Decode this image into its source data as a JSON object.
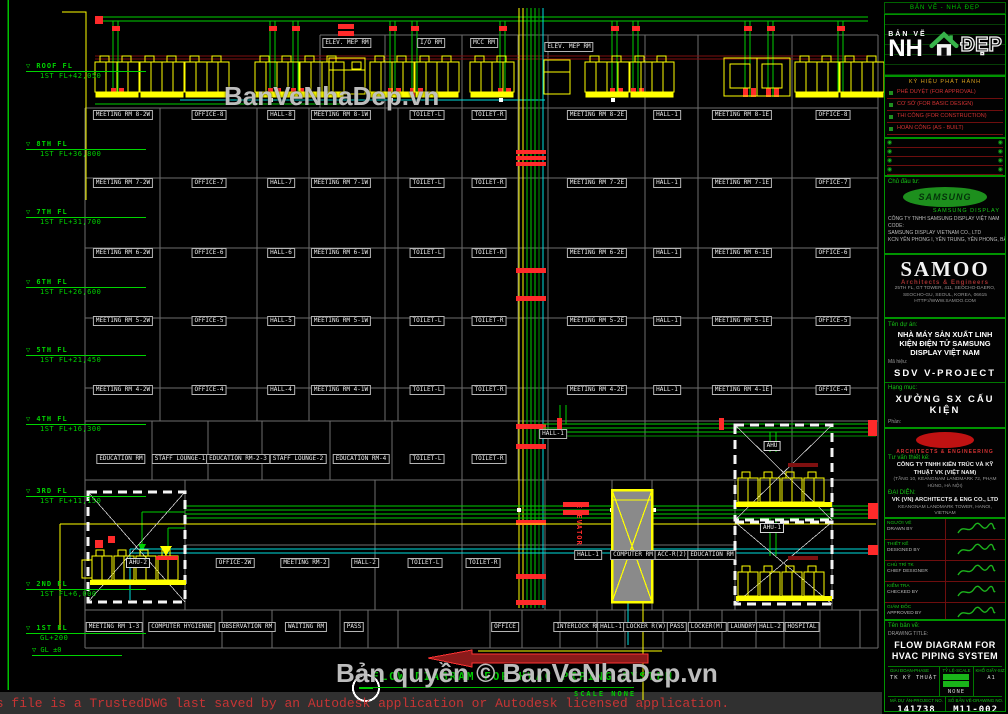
{
  "palette": {
    "bg": "#000000",
    "grid": "#6e6e6e",
    "green_pipe": "#00d000",
    "dark_green": "#008f00",
    "yellow": "#ffff00",
    "cyan": "#00dede",
    "red": "#ff2a2a",
    "dark_red": "#7f1010",
    "level_green": "#00d400",
    "watermark_gray": "#cdcdcd",
    "sidebar_green": "#009400"
  },
  "main": {
    "watermark_mid": "BanVeNhaDep.vn",
    "watermark_bottom": "Bản quyền © BanVeNhaDep.vn",
    "title": "FLOW DIAGRAM FOR HVAC PIPING SYSTEM",
    "scale": "SCALE  NONE",
    "trusted": "is file is a TrustedDWG last saved by an Autodesk application or Autodesk licensed application.",
    "elevator_tag": "ELEVATOR"
  },
  "floors": [
    {
      "n": "ROOF FL",
      "e": "1ST FL+42,050",
      "y": 62
    },
    {
      "n": "8TH FL",
      "e": "1ST FL+36,800",
      "y": 140
    },
    {
      "n": "7TH FL",
      "e": "1ST FL+31,700",
      "y": 208
    },
    {
      "n": "6TH FL",
      "e": "1ST FL+26,600",
      "y": 278
    },
    {
      "n": "5TH FL",
      "e": "1ST FL+21,450",
      "y": 346
    },
    {
      "n": "4TH FL",
      "e": "1ST FL+16,300",
      "y": 415
    },
    {
      "n": "3RD FL",
      "e": "1ST FL+11,150",
      "y": 487
    },
    {
      "n": "2ND FL",
      "e": "1ST FL+6,000",
      "y": 580
    },
    {
      "n": "1ST FL",
      "e": "GL+200",
      "y": 624,
      "extra": "GL ±0"
    }
  ],
  "room_labels": [
    {
      "t": "ELEV. MEP RM",
      "x": 347,
      "y": 42
    },
    {
      "t": "I/O RM",
      "x": 431,
      "y": 42
    },
    {
      "t": "MCC RM",
      "x": 484,
      "y": 42
    },
    {
      "t": "ELEV. MEP RM",
      "x": 569,
      "y": 46
    },
    {
      "t": "MEETING RM 8-2W",
      "x": 123,
      "y": 114
    },
    {
      "t": "OFFICE-8",
      "x": 209,
      "y": 114
    },
    {
      "t": "HALL-8",
      "x": 281,
      "y": 114
    },
    {
      "t": "MEETING RM 8-1W",
      "x": 341,
      "y": 114
    },
    {
      "t": "TOILET-L",
      "x": 427,
      "y": 114
    },
    {
      "t": "TOILET-R",
      "x": 489,
      "y": 114
    },
    {
      "t": "MEETING RM 8-2E",
      "x": 597,
      "y": 114
    },
    {
      "t": "HALL-1",
      "x": 667,
      "y": 114
    },
    {
      "t": "MEETING RM 8-1E",
      "x": 742,
      "y": 114
    },
    {
      "t": "OFFICE-8",
      "x": 833,
      "y": 114
    },
    {
      "t": "MEETING RM 7-2W",
      "x": 123,
      "y": 182
    },
    {
      "t": "OFFICE-7",
      "x": 209,
      "y": 182
    },
    {
      "t": "HALL-7",
      "x": 281,
      "y": 182
    },
    {
      "t": "MEETING RM 7-1W",
      "x": 341,
      "y": 182
    },
    {
      "t": "TOILET-L",
      "x": 427,
      "y": 182
    },
    {
      "t": "TOILET-R",
      "x": 489,
      "y": 182
    },
    {
      "t": "MEETING RM 7-2E",
      "x": 597,
      "y": 182
    },
    {
      "t": "HALL-1",
      "x": 667,
      "y": 182
    },
    {
      "t": "MEETING RM 7-1E",
      "x": 742,
      "y": 182
    },
    {
      "t": "OFFICE-7",
      "x": 833,
      "y": 182
    },
    {
      "t": "MEETING RM 6-2W",
      "x": 123,
      "y": 252
    },
    {
      "t": "OFFICE-6",
      "x": 209,
      "y": 252
    },
    {
      "t": "HALL-6",
      "x": 281,
      "y": 252
    },
    {
      "t": "MEETING RM 6-1W",
      "x": 341,
      "y": 252
    },
    {
      "t": "TOILET-L",
      "x": 427,
      "y": 252
    },
    {
      "t": "TOILET-R",
      "x": 489,
      "y": 252
    },
    {
      "t": "MEETING RM 6-2E",
      "x": 597,
      "y": 252
    },
    {
      "t": "HALL-1",
      "x": 667,
      "y": 252
    },
    {
      "t": "MEETING RM 6-1E",
      "x": 742,
      "y": 252
    },
    {
      "t": "OFFICE-6",
      "x": 833,
      "y": 252
    },
    {
      "t": "MEETING RM 5-2W",
      "x": 123,
      "y": 320
    },
    {
      "t": "OFFICE-5",
      "x": 209,
      "y": 320
    },
    {
      "t": "HALL-5",
      "x": 281,
      "y": 320
    },
    {
      "t": "MEETING RM 5-1W",
      "x": 341,
      "y": 320
    },
    {
      "t": "TOILET-L",
      "x": 427,
      "y": 320
    },
    {
      "t": "TOILET-R",
      "x": 489,
      "y": 320
    },
    {
      "t": "MEETING RM 5-2E",
      "x": 597,
      "y": 320
    },
    {
      "t": "HALL-1",
      "x": 667,
      "y": 320
    },
    {
      "t": "MEETING RM 5-1E",
      "x": 742,
      "y": 320
    },
    {
      "t": "OFFICE-5",
      "x": 833,
      "y": 320
    },
    {
      "t": "MEETING RM 4-2W",
      "x": 123,
      "y": 389
    },
    {
      "t": "OFFICE-4",
      "x": 209,
      "y": 389
    },
    {
      "t": "HALL-4",
      "x": 281,
      "y": 389
    },
    {
      "t": "MEETING RM 4-1W",
      "x": 341,
      "y": 389
    },
    {
      "t": "TOILET-L",
      "x": 427,
      "y": 389
    },
    {
      "t": "TOILET-R",
      "x": 489,
      "y": 389
    },
    {
      "t": "MEETING RM 4-2E",
      "x": 597,
      "y": 389
    },
    {
      "t": "HALL-1",
      "x": 667,
      "y": 389
    },
    {
      "t": "MEETING RM 4-1E",
      "x": 742,
      "y": 389
    },
    {
      "t": "OFFICE-4",
      "x": 833,
      "y": 389
    },
    {
      "t": "HALL-1",
      "x": 553,
      "y": 433
    },
    {
      "t": "EDUCATION RM",
      "x": 121,
      "y": 458
    },
    {
      "t": "STAFF LOUNGE-1",
      "x": 180,
      "y": 458
    },
    {
      "t": "EDUCATION RM-2-3",
      "x": 238,
      "y": 458
    },
    {
      "t": "STAFF LOUNGE-2",
      "x": 298,
      "y": 458
    },
    {
      "t": "EDUCATION RM-4",
      "x": 361,
      "y": 458
    },
    {
      "t": "TOILET-L",
      "x": 427,
      "y": 458
    },
    {
      "t": "TOILET-R",
      "x": 489,
      "y": 458
    },
    {
      "t": "OFFICE-2W",
      "x": 235,
      "y": 562
    },
    {
      "t": "MEETING RM-2",
      "x": 305,
      "y": 562
    },
    {
      "t": "HALL-2",
      "x": 365,
      "y": 562
    },
    {
      "t": "TOILET-L",
      "x": 425,
      "y": 562
    },
    {
      "t": "TOILET-R",
      "x": 483,
      "y": 562
    },
    {
      "t": "HALL-1",
      "x": 588,
      "y": 554
    },
    {
      "t": "COMPUTER RM",
      "x": 633,
      "y": 554
    },
    {
      "t": "ACC-R(2)",
      "x": 672,
      "y": 554
    },
    {
      "t": "EDUCATION RM",
      "x": 712,
      "y": 554
    },
    {
      "t": "MEETING RM 1-3",
      "x": 114,
      "y": 626
    },
    {
      "t": "COMPUTER HYGIENNE",
      "x": 182,
      "y": 626
    },
    {
      "t": "OBSERVATION RM",
      "x": 247,
      "y": 626
    },
    {
      "t": "WAITING RM",
      "x": 306,
      "y": 626
    },
    {
      "t": "PASS",
      "x": 354,
      "y": 626
    },
    {
      "t": "OFFICE",
      "x": 505,
      "y": 626
    },
    {
      "t": "INTERLOCK RM",
      "x": 578,
      "y": 626
    },
    {
      "t": "HALL-1",
      "x": 611,
      "y": 626
    },
    {
      "t": "LOCKER R(W)",
      "x": 646,
      "y": 626
    },
    {
      "t": "PASS",
      "x": 677,
      "y": 626
    },
    {
      "t": "LOCKER(M)",
      "x": 707,
      "y": 626
    },
    {
      "t": "LAUNDRY",
      "x": 743,
      "y": 626
    },
    {
      "t": "HALL-2",
      "x": 770,
      "y": 626
    },
    {
      "t": "HOSPITAL",
      "x": 802,
      "y": 626
    }
  ],
  "equipment_labels": [
    {
      "t": "AHU-2",
      "x": 138,
      "y": 562
    },
    {
      "t": "AHU",
      "x": 772,
      "y": 445
    },
    {
      "t": "AHU-1",
      "x": 772,
      "y": 527
    }
  ],
  "sidebar": {
    "top_note": "BẢN VẼ - NHÀ ĐẸP",
    "logo": {
      "line1": "BẢN VẼ",
      "line2": "NH",
      "line3": "ĐẸP"
    },
    "issue_note": "KÝ HIỆU PHÁT HÀNH",
    "revisions": [
      "PHÊ DUYỆT (FOR APPROVAL)",
      "CƠ SỞ (FOR BASIC DESIGN)",
      "THI CÔNG (FOR CONSTRUCTION)",
      "HOÀN CÔNG (AS - BUILT)"
    ],
    "symbols": [
      {
        "l": "◉",
        "r": "◉"
      },
      {
        "l": "◉",
        "r": "◉"
      },
      {
        "l": "◉",
        "r": "◉"
      },
      {
        "l": "◉",
        "r": "◉"
      }
    ],
    "owner": {
      "label": "Chủ đầu tư:",
      "logo_text": "SAMSUNG",
      "logo_sub": "SAMSUNG DISPLAY",
      "lines": [
        "CÔNG TY TNHH SAMSUNG DISPLAY VIỆT NAM",
        "CODE:",
        "SAMSUNG DISPLAY VIETNAM CO., LTD",
        "KCN YÊN PHONG I, YÊN TRUNG, YÊN PHONG, BẮC NINH"
      ]
    },
    "samoo": {
      "name": "SAMOO",
      "tagline": "Architects & Engineers",
      "lines": [
        "25TH FL, GT TOWER, 411, SEOCHO-DAERO,",
        "SEOCHO-GU, SEOUL, KOREA, 06615",
        "HTTP://WWW.SAMOO.COM"
      ]
    },
    "project": {
      "label": "Tên dự án:",
      "name": "NHÀ MÁY SẢN XUẤT LINH KIỆN ĐIỆN TỬ SAMSUNG DISPLAY VIỆT NAM",
      "code_label": "Mã hiệu:",
      "code": "SDV V-PROJECT",
      "item_label": "Hạng mục:",
      "item": "XƯỞNG SX CẤU KIỆN",
      "part_label": "Phần:",
      "part": "V3 OFFICE"
    },
    "designer": {
      "tagline": "ARCHITECTS & ENGINEERING",
      "label": "Tư vấn thiết kế:",
      "name_vi": "CÔNG TY TNHH KIẾN TRÚC VÀ KỸ THUẬT VK (VIỆT NAM)",
      "addr1": "(TẦNG 10, KEANGNAM LANDMARK 72, PHẠM HÙNG, HÀ NỘI)",
      "label2": "ĐẠI DIỆN:",
      "name_en": "VK (VN) ARCHITECTS & ENG CO., LTD",
      "addr2": "KEANGNAM LANDMARK TOWER, HANOI, VIETNAM"
    },
    "signatures": [
      {
        "vi": "NGƯỜI VẼ",
        "en": "DRAWN BY"
      },
      {
        "vi": "THIẾT KẾ",
        "en": "DESIGNED BY"
      },
      {
        "vi": "CHỦ TRÌ TK",
        "en": "CHIEF DESIGNER"
      },
      {
        "vi": "KIỂM TRA",
        "en": "CHECKED BY"
      },
      {
        "vi": "GIÁM ĐỐC",
        "en": "APPROVED BY"
      }
    ],
    "title_label": "Tên bản vẽ:",
    "drawing_title_label": "DRAWING TITLE:",
    "drawing_title": "FLOW DIAGRAM FOR HVAC PIPING SYSTEM",
    "meta1": [
      {
        "l": "GIAI ĐOẠN-PHASE",
        "v": "TK KỸ THUẬT",
        "swatches": false
      },
      {
        "l": "TỶ LỆ-SCALE",
        "v": "NONE",
        "swatches": true
      },
      {
        "l": "KHỔ GIẤY-SIZE",
        "v": "A1",
        "swatches": false
      }
    ],
    "meta2": [
      {
        "l": "MÃ DỰ ÁN-PROJECT NO.",
        "v": "141738"
      },
      {
        "l": "SỐ BẢN VẼ-DRAWING NO.",
        "v": "M11-002"
      }
    ]
  }
}
